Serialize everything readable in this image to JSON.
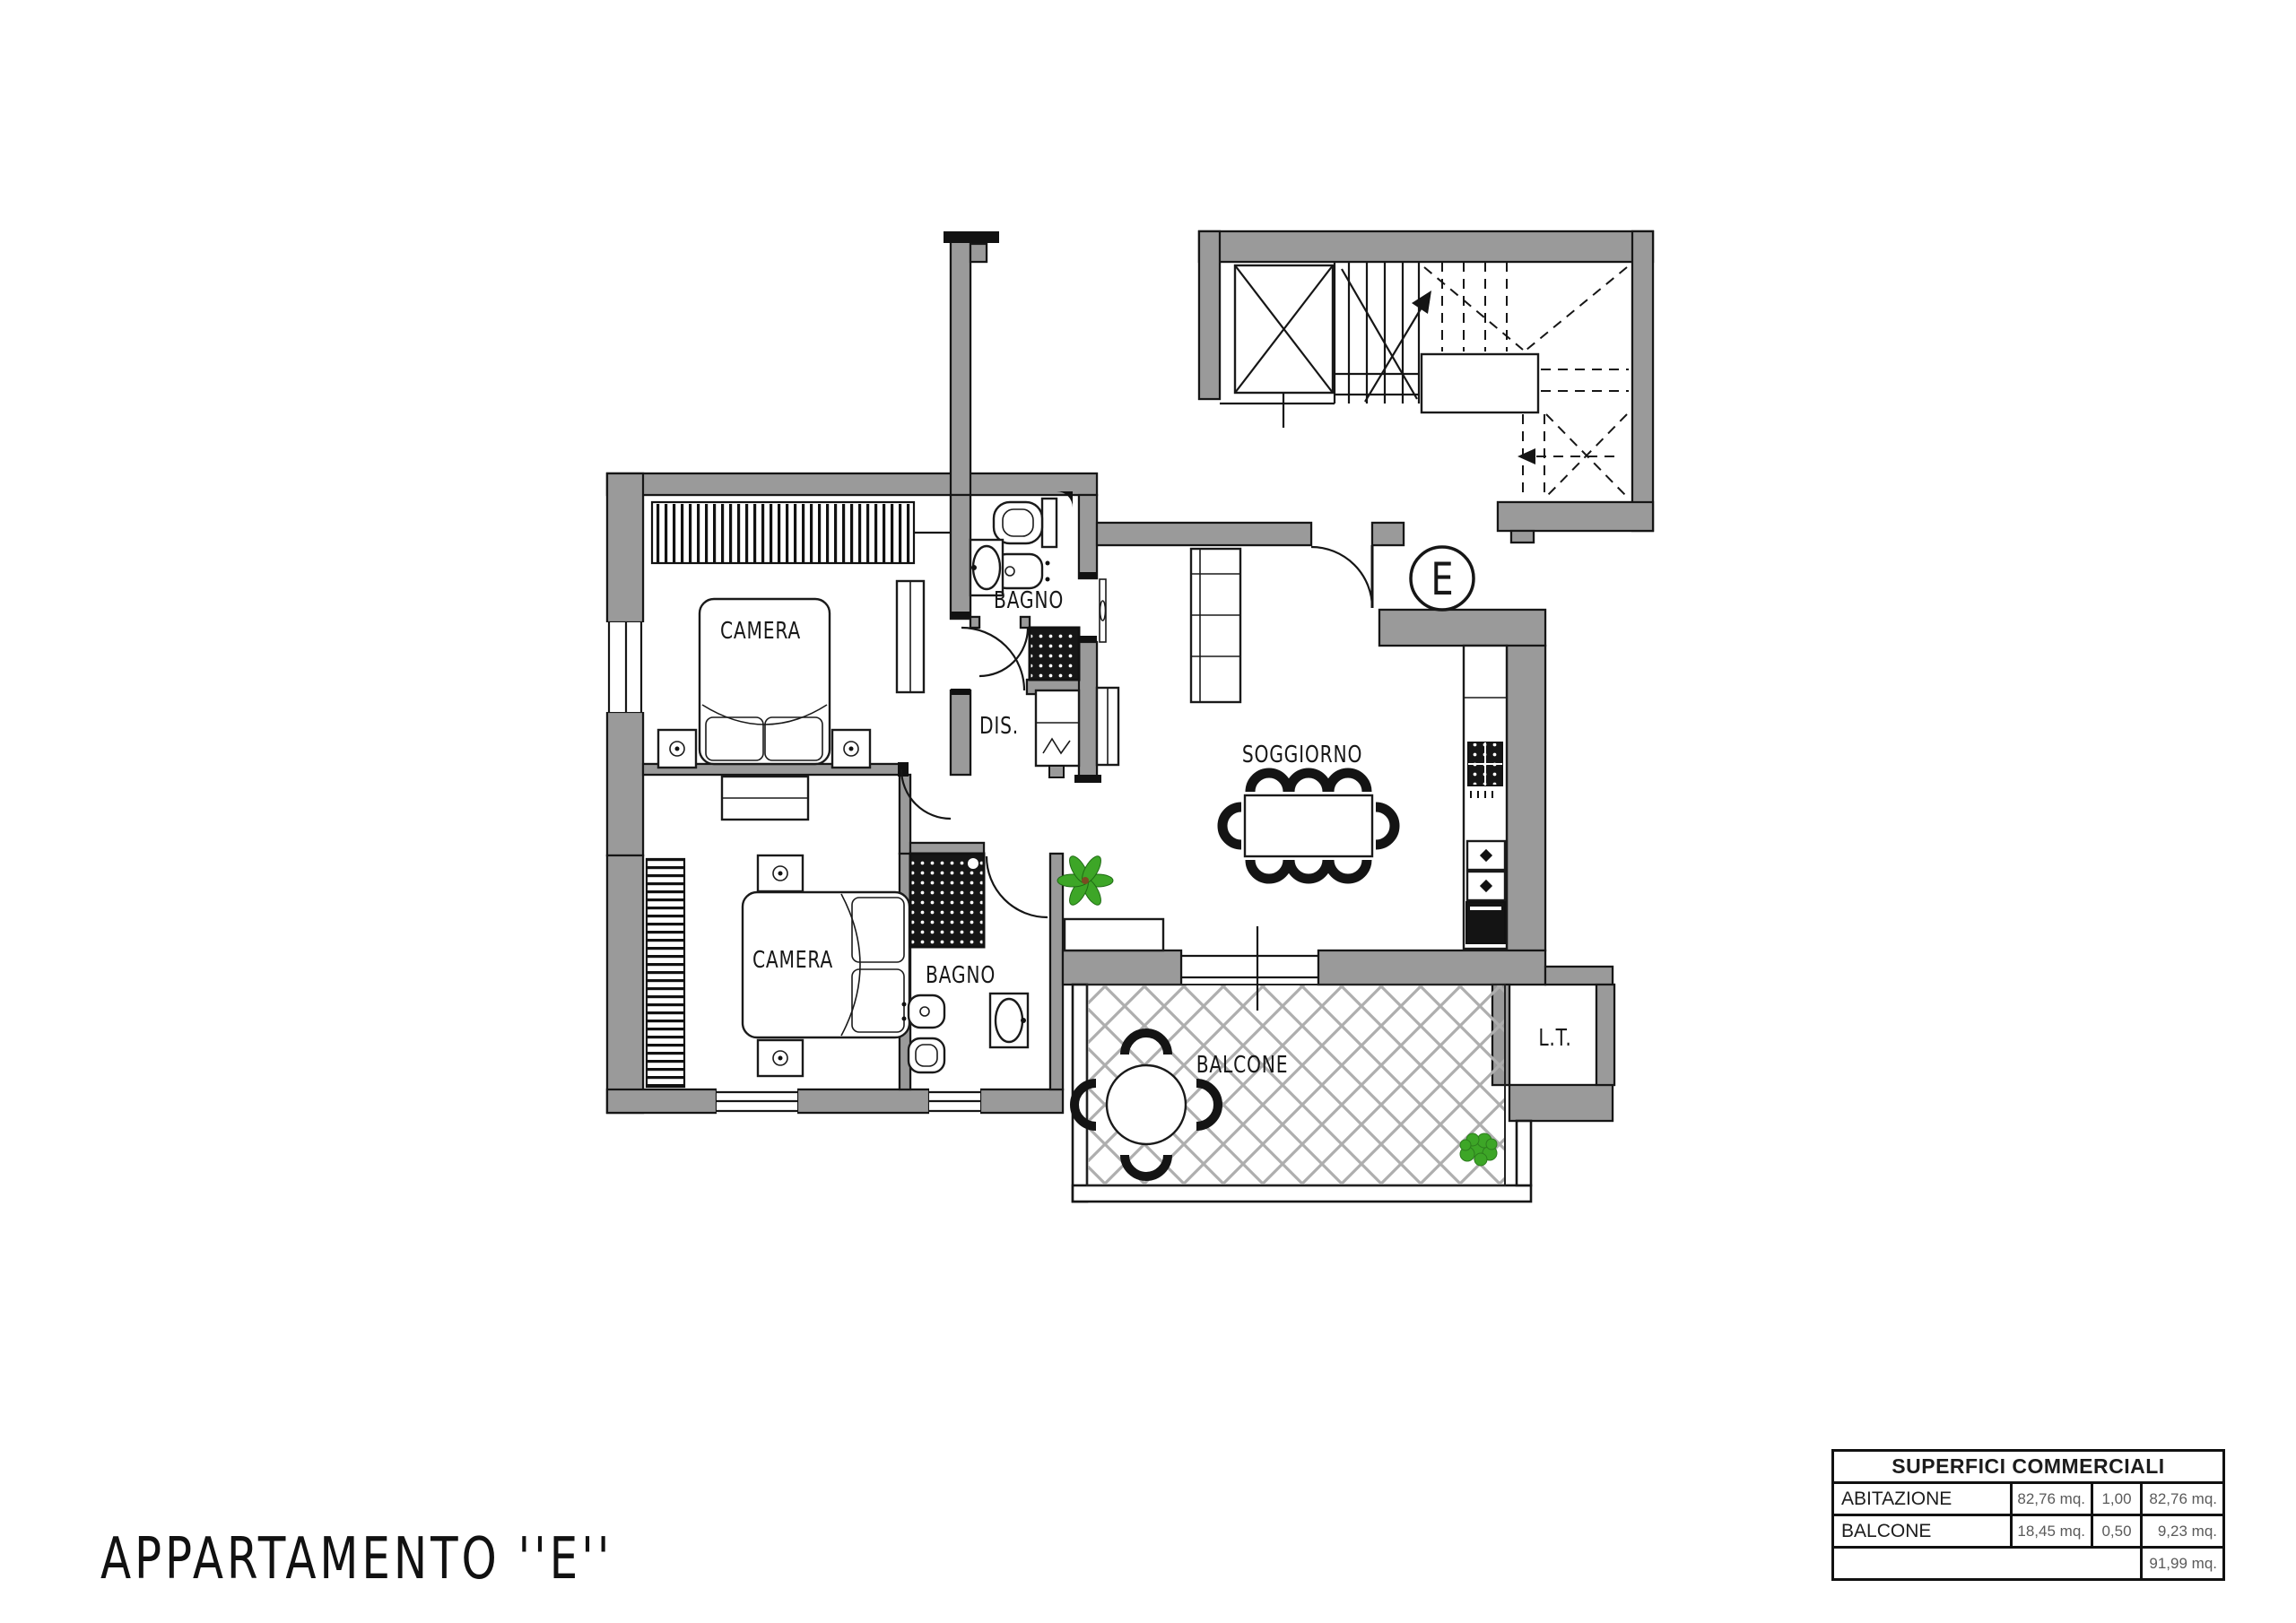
{
  "title": "APPARTAMENTO ''E''",
  "unit_badge": "E",
  "rooms": {
    "camera1": {
      "label": "CAMERA"
    },
    "camera2": {
      "label": "CAMERA"
    },
    "bagno1": {
      "label": "BAGNO"
    },
    "bagno2": {
      "label": "BAGNO"
    },
    "dis": {
      "label": "DIS."
    },
    "soggiorno": {
      "label": "SOGGIORNO"
    },
    "balcone": {
      "label": "BALCONE"
    },
    "lt": {
      "label": "L.T."
    }
  },
  "summary_table": {
    "title": "SUPERFICI COMMERCIALI",
    "rows": [
      {
        "room": "ABITAZIONE",
        "area": "82,76 mq.",
        "coefficient": "1,00",
        "weighted_area": "82,76 mq."
      },
      {
        "room": "BALCONE",
        "area": "18,45 mq.",
        "coefficient": "0,50",
        "weighted_area": "9,23 mq."
      }
    ],
    "total": "91,99 mq."
  },
  "colors": {
    "wall": "#9a9a9a",
    "line": "#161616",
    "lattice": "#aeaeae",
    "plant_green": "#3da627",
    "background": "#ffffff"
  }
}
